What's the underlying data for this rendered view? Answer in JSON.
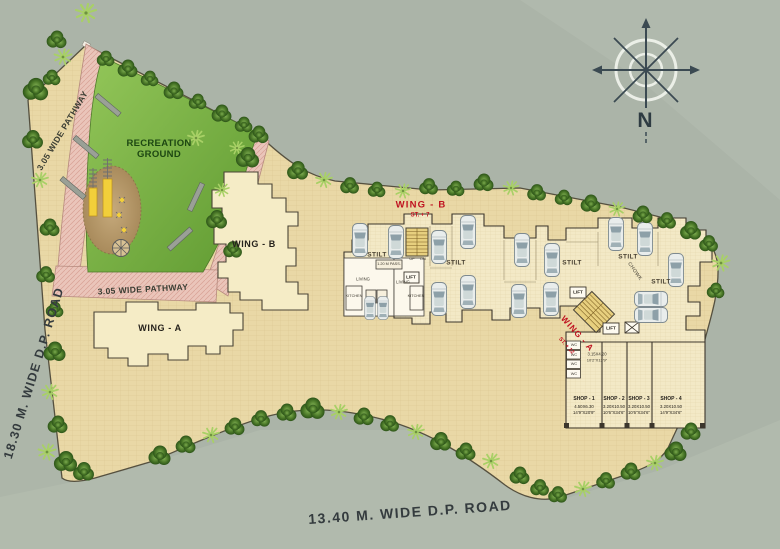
{
  "site": {
    "roads": {
      "left": "18.30 M. WIDE D.P. ROAD",
      "bottom": "13.40 M. WIDE D.P. ROAD"
    },
    "pathway_label": "3.05 WIDE PATHWAY",
    "recreation_label": "RECREATION GROUND",
    "compass_n": "N"
  },
  "footprints": {
    "wing_a": "WING - A",
    "wing_b": "WING - B"
  },
  "plan": {
    "wing_b_title": "WING - B",
    "wing_b_storeys": "ST. + 7",
    "wing_a_title": "WING - A",
    "wing_a_storeys": "ST. + 12",
    "stilt_label": "STILT",
    "chowk_label": "CHOWK",
    "lift_label": "LIFT",
    "living_label": "LIVING",
    "kitchen_label": "KITCHEN",
    "passage_label": "1.20 M PASS.",
    "up_label": "UP",
    "dn_label": "DN",
    "wc_label": "WC",
    "wc_block": {
      "dim_m": "3.15X4.20",
      "dim_ft": "10'2\"X13'9\""
    },
    "shops": [
      {
        "name": "SHOP - 1",
        "dim_m": "4.50X6.30",
        "dim_ft": "14'9\"X20'9\""
      },
      {
        "name": "SHOP - 2",
        "dim_m": "3.20X10.50",
        "dim_ft": "10'6\"X34'6\""
      },
      {
        "name": "SHOP - 3",
        "dim_m": "3.20X10.50",
        "dim_ft": "10'6\"X34'6\""
      },
      {
        "name": "SHOP - 4",
        "dim_m": "3.20X10.50",
        "dim_ft": "14'9\"X34'6\""
      }
    ]
  },
  "colors": {
    "accent_red": "#bf1220",
    "plot_tan": "#e9d8a6",
    "plan_cream": "#f3e9c6",
    "recreation_green": "#6fae3a",
    "pathway_pink": "#eac5ba",
    "road_gray": "#abb4a8",
    "play_area_brown": "#b89a6e"
  }
}
